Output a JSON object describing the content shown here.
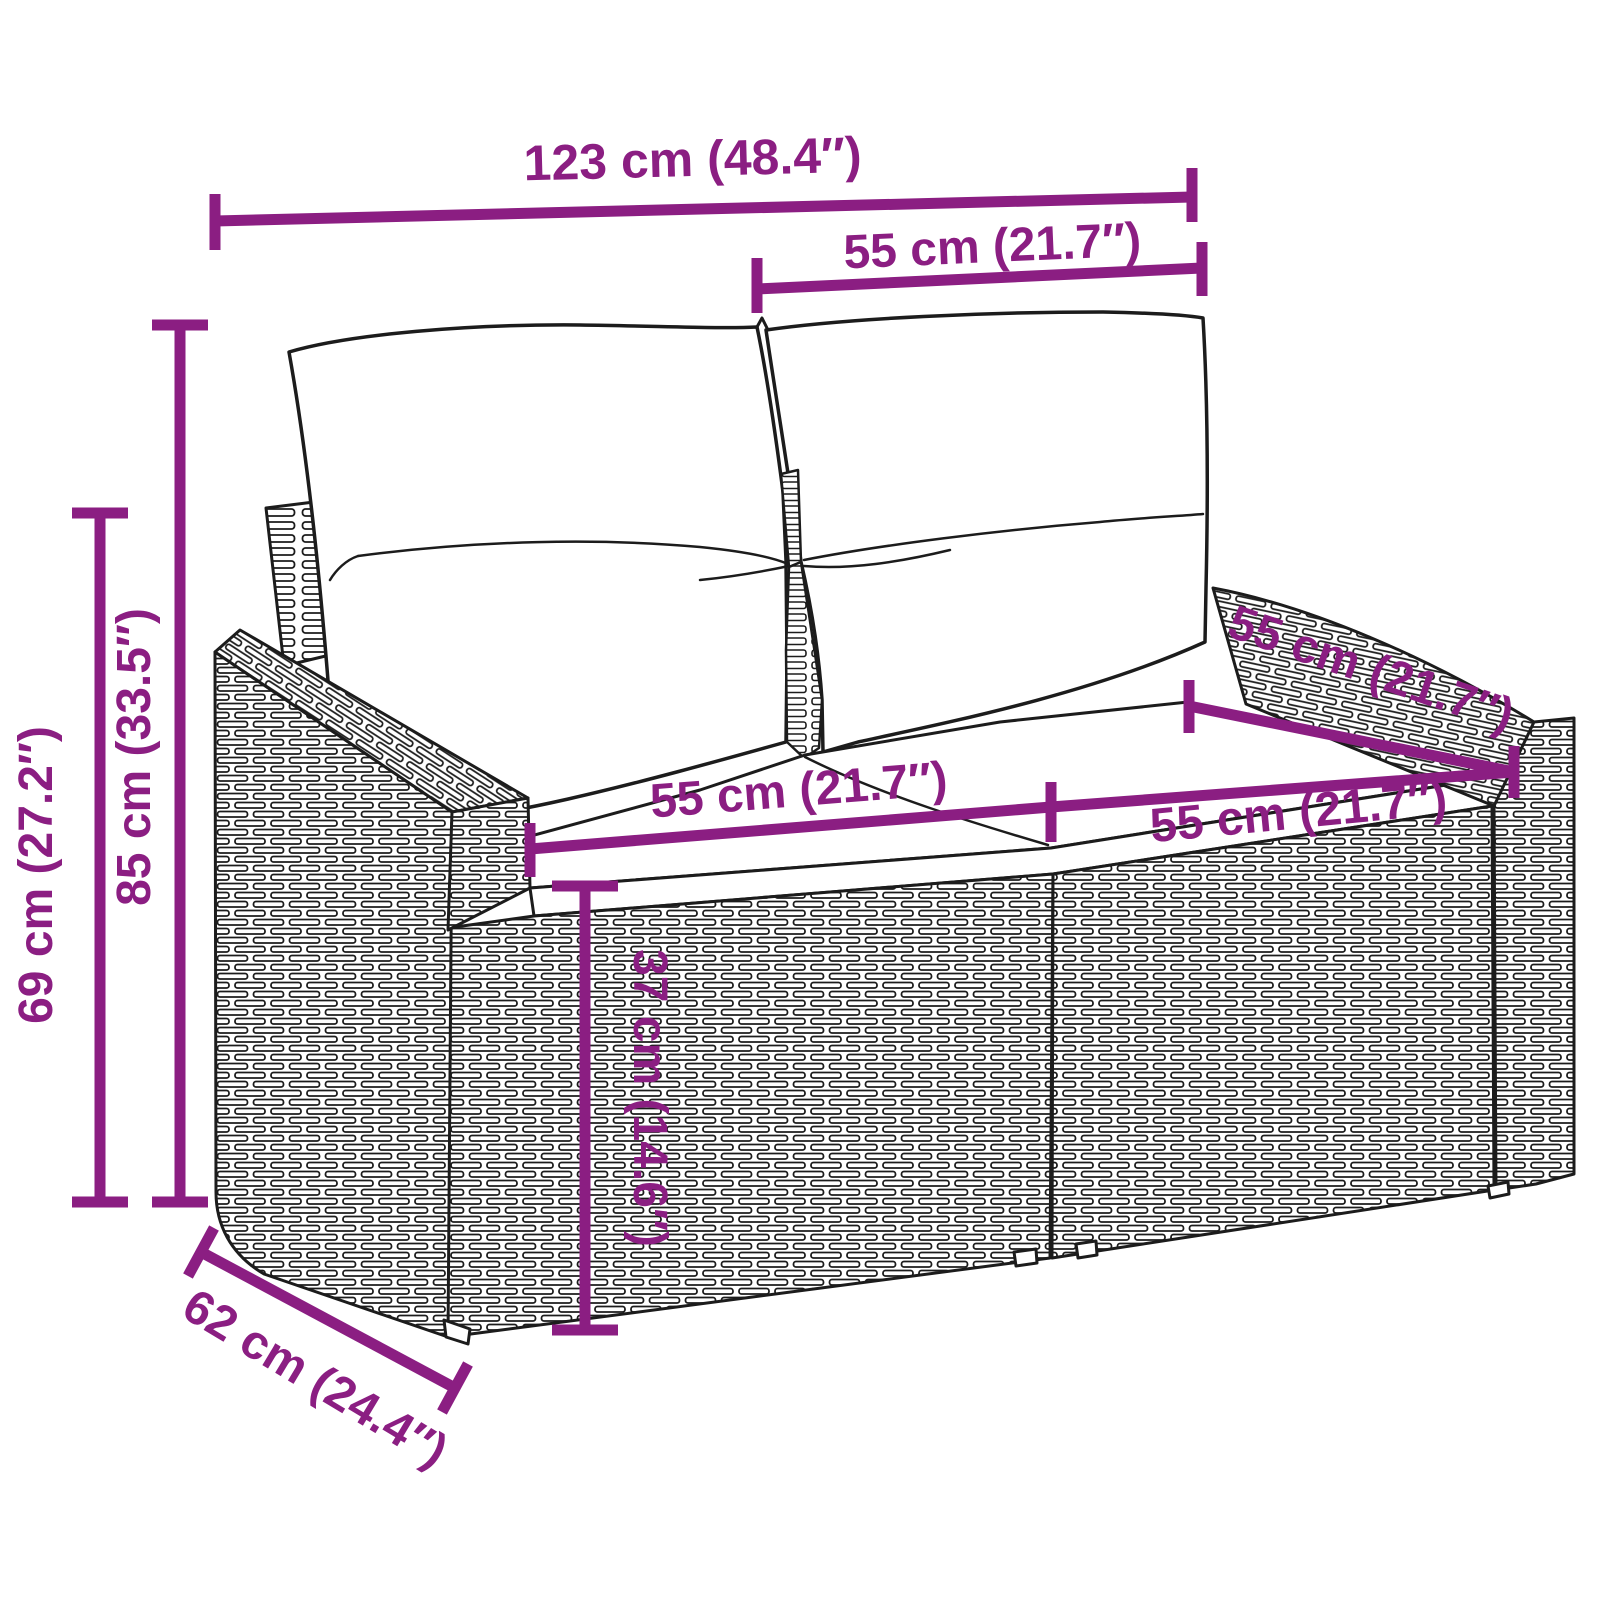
{
  "accent_color": "#8B1E82",
  "line_art_color": "#1c1c1c",
  "subject": "two-seater rattan garden sofa with back and seat cushions, dimension drawing",
  "dimensions": {
    "overall_width": {
      "label": "123 cm (48.4″)",
      "cm": 123,
      "inches": 48.4
    },
    "backrest_section": {
      "label": "55 cm (21.7″)",
      "cm": 55,
      "inches": 21.7
    },
    "seat_depth": {
      "label": "55 cm (21.7″)",
      "cm": 55,
      "inches": 21.7
    },
    "seat_width_left": {
      "label": "55 cm (21.7″)",
      "cm": 55,
      "inches": 21.7
    },
    "seat_width_right": {
      "label": "55 cm (21.7″)",
      "cm": 55,
      "inches": 21.7
    },
    "total_height": {
      "label": "85 cm (33.5″)",
      "cm": 85,
      "inches": 33.5
    },
    "armrest_height": {
      "label": "69 cm (27.2″)",
      "cm": 69,
      "inches": 27.2
    },
    "seat_base_height": {
      "label": "37 cm (14.6″)",
      "cm": 37,
      "inches": 14.6
    },
    "overall_depth": {
      "label": "62 cm (24.4″)",
      "cm": 62,
      "inches": 24.4
    }
  }
}
